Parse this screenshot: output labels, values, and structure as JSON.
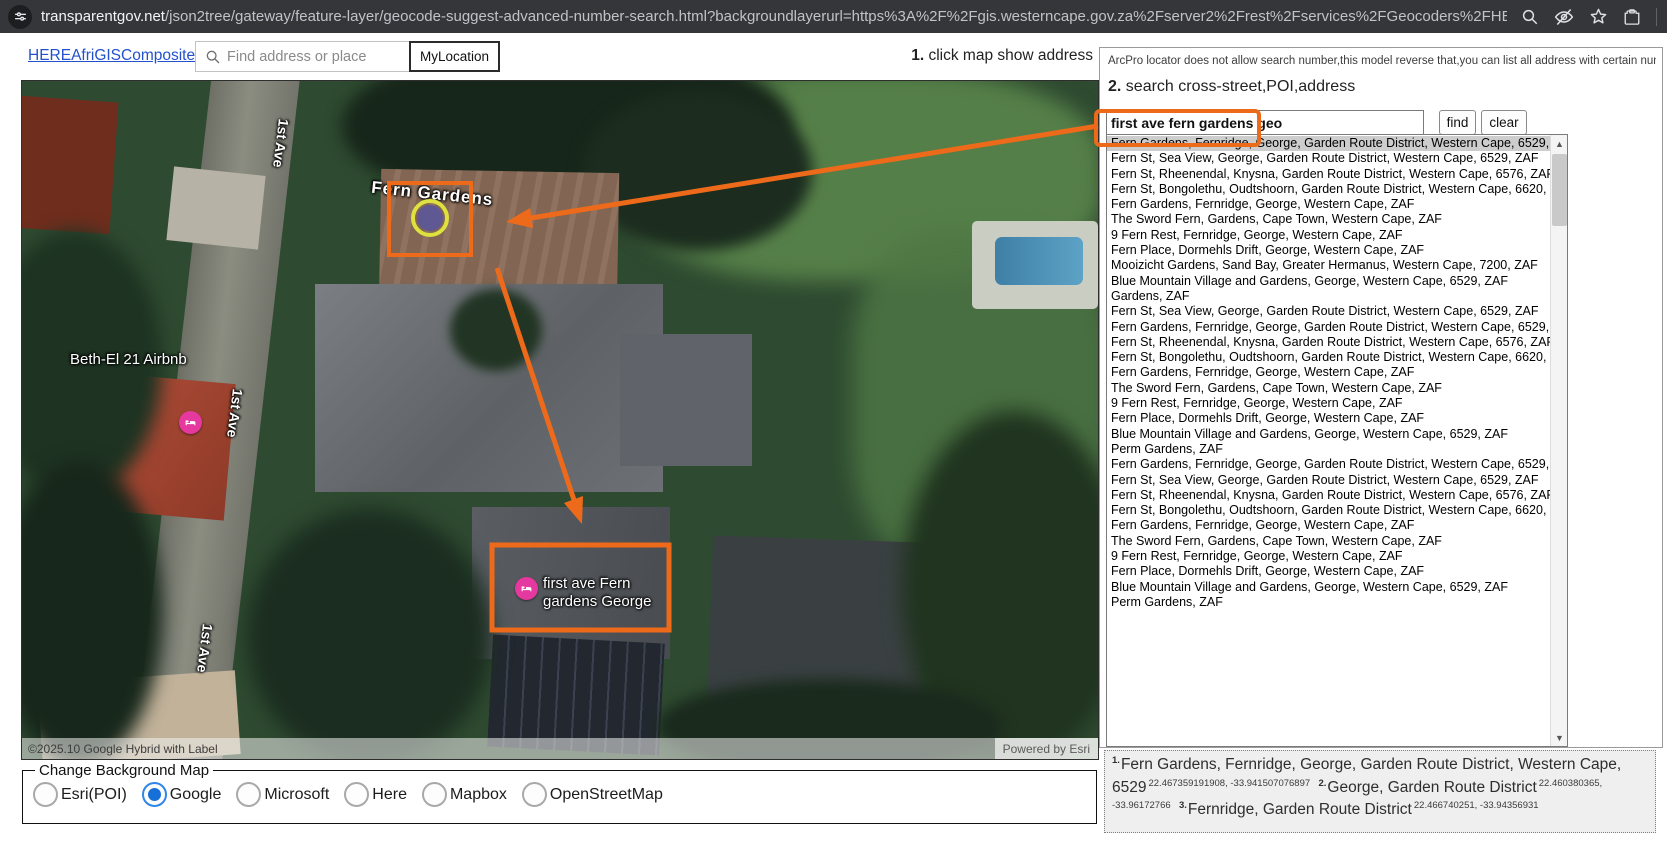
{
  "browser": {
    "url_domain": "transparentgov.net",
    "url_path": "/json2tree/gateway/feature-layer/geocode-suggest-advanced-number-search.html?backgroundlayerurl=https%3A%2F%2Fgis.westerncape.gov.za%2Fserver2%2Frest%2Fservices%2FGeocoders%2FHEREAfriGISCompo…"
  },
  "toolbar": {
    "locator_link": "HEREAfriGISComposite",
    "search_placeholder": "Find address or place",
    "my_location_label": "MyLocation",
    "step1_prefix": "1.",
    "step1_text": " click map show address"
  },
  "map": {
    "labels": {
      "fern_gardens": "Fern Gardens",
      "airbnb": "Beth-El 21 Airbnb",
      "poi_line1": "first ave Fern",
      "poi_line2": "gardens George",
      "street": "1st Ave"
    },
    "attribution_left": "©2025.10 Google Hybrid with Label",
    "attribution_right": "Powered by Esri"
  },
  "background_map": {
    "legend": "Change Background Map",
    "options": [
      {
        "label": "Esri(POI)",
        "selected": false
      },
      {
        "label": "Google",
        "selected": true
      },
      {
        "label": "Microsoft",
        "selected": false
      },
      {
        "label": "Here",
        "selected": false
      },
      {
        "label": "Mapbox",
        "selected": false
      },
      {
        "label": "OpenStreetMap",
        "selected": false
      }
    ]
  },
  "panel": {
    "note": "ArcPro locator does not allow search number,this model reverse that,you can list all address with certain number",
    "step2_prefix": "2.",
    "step2_text": " search cross-street,POI,address",
    "search_value": "first ave fern gardens geo",
    "find_label": "find",
    "clear_label": "clear",
    "results": [
      {
        "text": "Fern Gardens, Fernridge, George, Garden Route District, Western Cape, 6529, ZAF",
        "selected": true
      },
      {
        "text": "Fern St, Sea View, George, Garden Route District, Western Cape, 6529, ZAF",
        "selected": false
      },
      {
        "text": "Fern St, Rheenendal, Knysna, Garden Route District, Western Cape, 6576, ZAF",
        "selected": false
      },
      {
        "text": "Fern St, Bongolethu, Oudtshoorn, Garden Route District, Western Cape, 6620, ZAF",
        "selected": false
      },
      {
        "text": "Fern Gardens, Fernridge, George, Western Cape, ZAF",
        "selected": false
      },
      {
        "text": "The Sword Fern, Gardens, Cape Town, Western Cape, ZAF",
        "selected": false
      },
      {
        "text": "9 Fern Rest, Fernridge, George, Western Cape, ZAF",
        "selected": false
      },
      {
        "text": "Fern Place, Dormehls Drift, George, Western Cape, ZAF",
        "selected": false
      },
      {
        "text": "Mooizicht Gardens, Sand Bay, Greater Hermanus, Western Cape, 7200, ZAF",
        "selected": false
      },
      {
        "text": "Blue Mountain Village and Gardens, George, Western Cape, 6529, ZAF",
        "selected": false
      },
      {
        "text": "Gardens, ZAF",
        "selected": false
      },
      {
        "text": "Fern St, Sea View, George, Garden Route District, Western Cape, 6529, ZAF",
        "selected": false
      },
      {
        "text": "Fern Gardens, Fernridge, George, Garden Route District, Western Cape, 6529, ZAF",
        "selected": false
      },
      {
        "text": "Fern St, Rheenendal, Knysna, Garden Route District, Western Cape, 6576, ZAF",
        "selected": false
      },
      {
        "text": "Fern St, Bongolethu, Oudtshoorn, Garden Route District, Western Cape, 6620, ZAF",
        "selected": false
      },
      {
        "text": "Fern Gardens, Fernridge, George, Western Cape, ZAF",
        "selected": false
      },
      {
        "text": "The Sword Fern, Gardens, Cape Town, Western Cape, ZAF",
        "selected": false
      },
      {
        "text": "9 Fern Rest, Fernridge, George, Western Cape, ZAF",
        "selected": false
      },
      {
        "text": "Fern Place, Dormehls Drift, George, Western Cape, ZAF",
        "selected": false
      },
      {
        "text": "Blue Mountain Village and Gardens, George, Western Cape, 6529, ZAF",
        "selected": false
      },
      {
        "text": "Perm Gardens, ZAF",
        "selected": false
      },
      {
        "text": "Fern Gardens, Fernridge, George, Garden Route District, Western Cape, 6529, ZAF",
        "selected": false
      },
      {
        "text": "Fern St, Sea View, George, Garden Route District, Western Cape, 6529, ZAF",
        "selected": false
      },
      {
        "text": "Fern St, Rheenendal, Knysna, Garden Route District, Western Cape, 6576, ZAF",
        "selected": false
      },
      {
        "text": "Fern St, Bongolethu, Oudtshoorn, Garden Route District, Western Cape, 6620, ZAF",
        "selected": false
      },
      {
        "text": "Fern Gardens, Fernridge, George, Western Cape, ZAF",
        "selected": false
      },
      {
        "text": "The Sword Fern, Gardens, Cape Town, Western Cape, ZAF",
        "selected": false
      },
      {
        "text": "9 Fern Rest, Fernridge, George, Western Cape, ZAF",
        "selected": false
      },
      {
        "text": "Fern Place, Dormehls Drift, George, Western Cape, ZAF",
        "selected": false
      },
      {
        "text": "Blue Mountain Village and Gardens, George, Western Cape, 6529, ZAF",
        "selected": false
      },
      {
        "text": "Perm Gardens, ZAF",
        "selected": false
      }
    ],
    "candidates": [
      {
        "index": "1.",
        "text": "Fern Gardens, Fernridge, George, Garden Route District, Western Cape, 6529",
        "coords": "22.467359191908, -33.941507076897"
      },
      {
        "index": "2.",
        "text": "George, Garden Route District",
        "coords": "22.460380365, -33.96172766"
      },
      {
        "index": "3.",
        "text": "Fernridge, Garden Route District",
        "coords": "22.466740251, -33.94356931"
      }
    ]
  },
  "colors": {
    "annotation_orange": "#ed6a1a",
    "marker_pink": "#e6399f",
    "radio_blue": "#1670d8",
    "link_blue": "#2151cc",
    "selected_row_gray": "#cdcdcd",
    "marker_purple": "#5d5796",
    "marker_ring_yellow": "#dde23f"
  }
}
